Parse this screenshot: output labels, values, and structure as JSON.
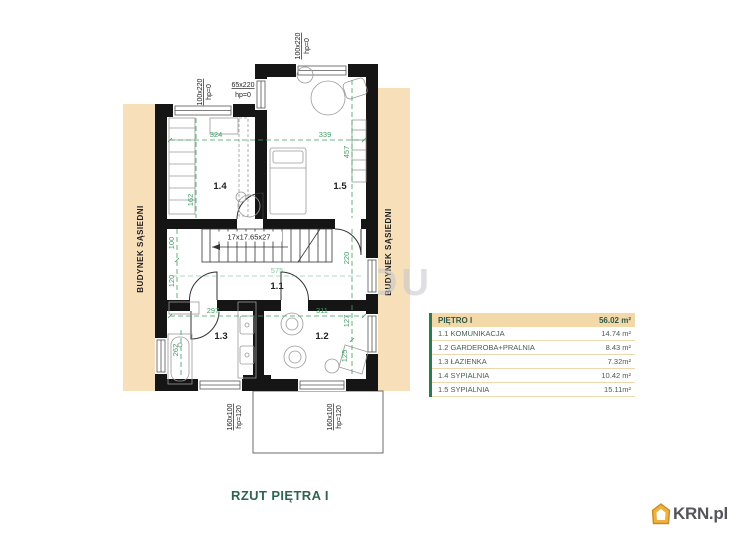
{
  "plan": {
    "title": "RZUT PIĘTRA I",
    "neighbor_left": "BUDYNEK SĄSIEDNI",
    "neighbor_right": "BUDYNEK SĄSIEDNI",
    "stairs_label": "17x17.65x27",
    "watermark": "DU",
    "rooms": {
      "r11": "1.1",
      "r12": "1.2",
      "r13": "1.3",
      "r14": "1.4",
      "r15": "1.5"
    },
    "dimensions": {
      "d324": "324",
      "d339": "339",
      "d457": "457",
      "d162": "162",
      "d100": "100",
      "d120": "120",
      "d220": "220",
      "d575": "575",
      "d297": "297",
      "d311": "311",
      "d127": "127",
      "d125": "125",
      "d262": "262"
    },
    "windows": {
      "top_left": "100x220",
      "top_left_hp": "hp=0",
      "step": "65x220",
      "step_hp": "hp=0",
      "top_right": "100x220",
      "top_right_hp": "hp=0",
      "bottom_left": "160x100",
      "bottom_left_hp": "hp=120",
      "bottom_right": "160x100",
      "bottom_right_hp": "hp=120"
    }
  },
  "legend": {
    "header": {
      "label": "PIĘTRO I",
      "area": "56.02 m²"
    },
    "rows": [
      {
        "label": "1.1 KOMUNIKACJA",
        "area": "14.74 m²"
      },
      {
        "label": "1.2 GARDEROBA+PRALNIA",
        "area": "8.43 m²"
      },
      {
        "label": "1.3 ŁAZIENKA",
        "area": "7.32m²"
      },
      {
        "label": "1.4 SYPIALNIA",
        "area": "10.42 m²"
      },
      {
        "label": "1.5 SYPIALNIA",
        "area": "15.11m²"
      }
    ]
  },
  "footer": {
    "logo_text": "KRN.pl"
  },
  "colors": {
    "dimension_green": "#3f9e63",
    "neighbor_band": "#f7dfba",
    "legend_header_bg": "#f3d9a8",
    "legend_accent": "#2d7a52",
    "title_green": "#2f6454",
    "logo_gold": "#efb23e",
    "logo_gray": "#54555a",
    "wall_black": "#151515"
  }
}
